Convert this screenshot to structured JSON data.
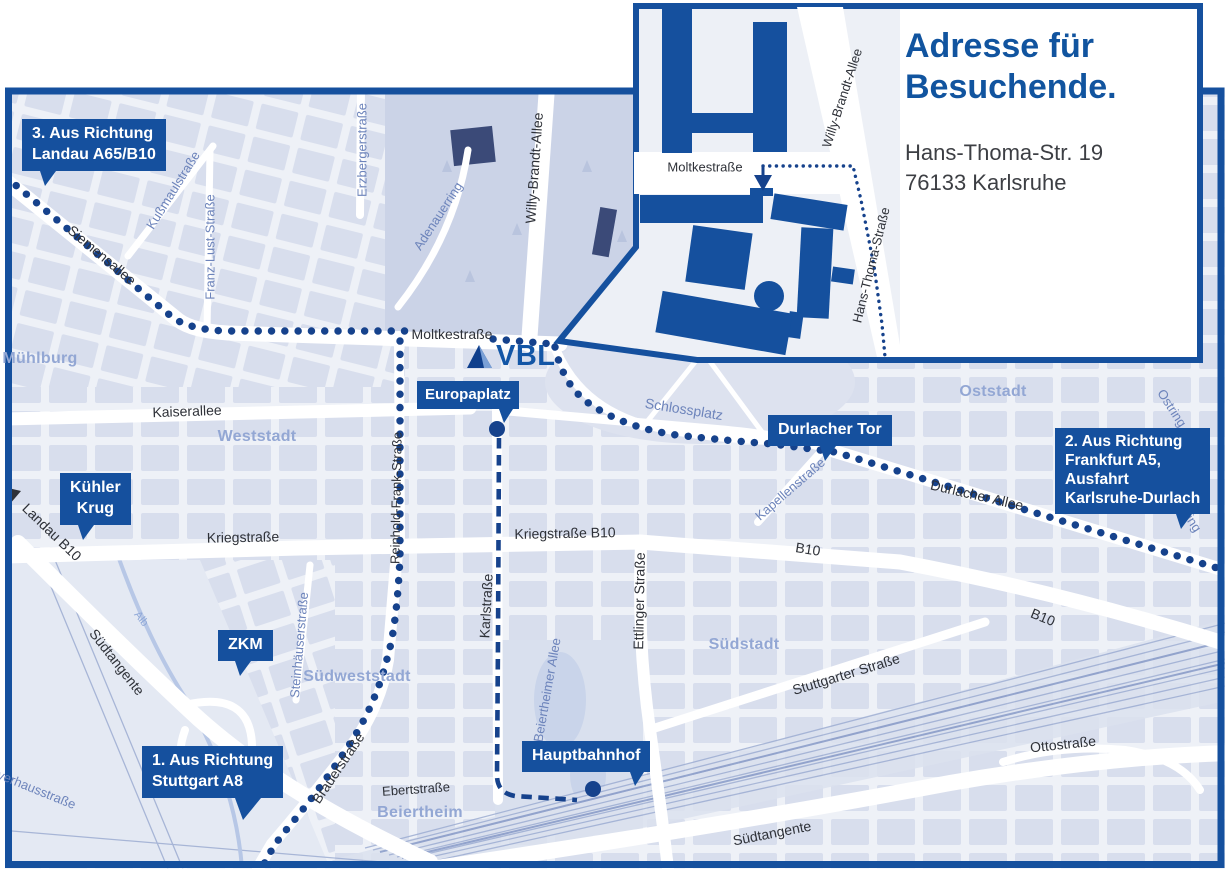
{
  "colors": {
    "brand_blue": "#15509e",
    "route_navy": "#16428c",
    "heading_blue": "#11549f"
  },
  "logo": {
    "text": "VBL"
  },
  "inset": {
    "title_line1": "Adresse für",
    "title_line2": "Besuchende.",
    "address_line1": "Hans-Thoma-Str. 19",
    "address_line2": "76133 Karlsruhe",
    "street_moltke": "Moltkestraße",
    "street_willy_brandt": "Willy-Brandt-Allee",
    "street_hans_thoma": "Hans-Thoma-Straße"
  },
  "callouts": {
    "route3": {
      "line1": "3. Aus Richtung",
      "line2": "Landau A65/B10"
    },
    "route2": {
      "line1": "2. Aus Richtung",
      "line2": "Frankfurt A5,",
      "line3": "Ausfahrt",
      "line4": "Karlsruhe-Durlach"
    },
    "route1": {
      "line1": "1. Aus Richtung",
      "line2": "Stuttgart A8"
    },
    "kuehler_krug": {
      "line1": "Kühler",
      "line2": "Krug"
    },
    "zkm": "ZKM",
    "europaplatz": "Europaplatz",
    "durlacher_tor": "Durlacher Tor",
    "hauptbahnhof": "Hauptbahnhof"
  },
  "districts": [
    {
      "t": "Mühlburg",
      "x": 40,
      "y": 359
    },
    {
      "t": "Weststadt",
      "x": 257,
      "y": 437
    },
    {
      "t": "Oststadt",
      "x": 993,
      "y": 392
    },
    {
      "t": "Südstadt",
      "x": 744,
      "y": 645
    },
    {
      "t": "Südweststadt",
      "x": 357,
      "y": 677
    },
    {
      "t": "Beiertheim",
      "x": 420,
      "y": 813
    }
  ],
  "streets": [
    {
      "t": "Siemensallee",
      "x": 102,
      "y": 255,
      "r": 40,
      "c": "d",
      "s": 14
    },
    {
      "t": "Kußmaulstraße",
      "x": 173,
      "y": 190,
      "r": -58,
      "c": "b"
    },
    {
      "t": "Franz-Lust-Straße",
      "x": 210,
      "y": 247,
      "r": -90,
      "c": "b"
    },
    {
      "t": "Erzbergerstraße",
      "x": 362,
      "y": 150,
      "r": -90,
      "c": "b"
    },
    {
      "t": "Adenauerring",
      "x": 438,
      "y": 216,
      "r": -57,
      "c": "b"
    },
    {
      "t": "Willy-Brandt-Allee",
      "x": 534,
      "y": 168,
      "r": -86,
      "c": "d",
      "s": 14
    },
    {
      "t": "Moltkestraße",
      "x": 452,
      "y": 334,
      "r": 0,
      "c": "d",
      "s": 14
    },
    {
      "t": "Kaiserallee",
      "x": 187,
      "y": 411,
      "r": -2,
      "c": "d",
      "s": 14
    },
    {
      "t": "Reinhold-Frank-Straße",
      "x": 396,
      "y": 498,
      "r": -89,
      "c": "d"
    },
    {
      "t": "Kriegstraße",
      "x": 243,
      "y": 537,
      "r": -1,
      "c": "d",
      "s": 14
    },
    {
      "t": "Kriegstraße B10",
      "x": 565,
      "y": 533,
      "r": -1,
      "c": "d",
      "s": 14
    },
    {
      "t": "Karlstraße",
      "x": 486,
      "y": 606,
      "r": -87,
      "c": "d",
      "s": 14
    },
    {
      "t": "Ettlinger Straße",
      "x": 639,
      "y": 601,
      "r": -89,
      "c": "d",
      "s": 14
    },
    {
      "t": "Schlossplatz",
      "x": 684,
      "y": 409,
      "r": 9,
      "c": "b",
      "s": 14
    },
    {
      "t": "Kapellenstraße",
      "x": 790,
      "y": 489,
      "r": -41,
      "c": "b"
    },
    {
      "t": "Durlacher Allee",
      "x": 977,
      "y": 495,
      "r": 13,
      "c": "d",
      "s": 14
    },
    {
      "t": "B10",
      "x": 808,
      "y": 549,
      "r": 9,
      "c": "d",
      "s": 14
    },
    {
      "t": "B10",
      "x": 1043,
      "y": 617,
      "r": 22,
      "c": "d",
      "s": 14
    },
    {
      "t": "Ostring",
      "x": 1172,
      "y": 408,
      "r": 57,
      "c": "b"
    },
    {
      "t": "Ostring",
      "x": 1187,
      "y": 513,
      "r": 57,
      "c": "b"
    },
    {
      "t": "Südtangente",
      "x": 117,
      "y": 662,
      "r": 52,
      "c": "d",
      "s": 14
    },
    {
      "t": "Alb",
      "x": 141,
      "y": 619,
      "r": 52,
      "c": "l",
      "s": 11
    },
    {
      "t": "Steinhäuserstraße",
      "x": 299,
      "y": 645,
      "r": -85,
      "c": "b"
    },
    {
      "t": "Brauerstraße",
      "x": 338,
      "y": 768,
      "r": -56,
      "c": "d",
      "s": 14
    },
    {
      "t": "Ebertstraße",
      "x": 416,
      "y": 789,
      "r": -4,
      "c": "d"
    },
    {
      "t": "Beiertheimer Allee",
      "x": 547,
      "y": 690,
      "r": -80,
      "c": "b"
    },
    {
      "t": "Stuttgarter Straße",
      "x": 846,
      "y": 674,
      "r": -17,
      "c": "d",
      "s": 14
    },
    {
      "t": "Ottostraße",
      "x": 1063,
      "y": 744,
      "r": -6,
      "c": "d",
      "s": 14
    },
    {
      "t": "Südtangente",
      "x": 772,
      "y": 833,
      "r": -11,
      "c": "d",
      "s": 14
    },
    {
      "t": "Pulverhausstraße",
      "x": 28,
      "y": 786,
      "r": 22,
      "c": "b"
    },
    {
      "t": "Landau B10",
      "x": 52,
      "y": 532,
      "r": 44,
      "c": "d",
      "s": 14
    }
  ]
}
